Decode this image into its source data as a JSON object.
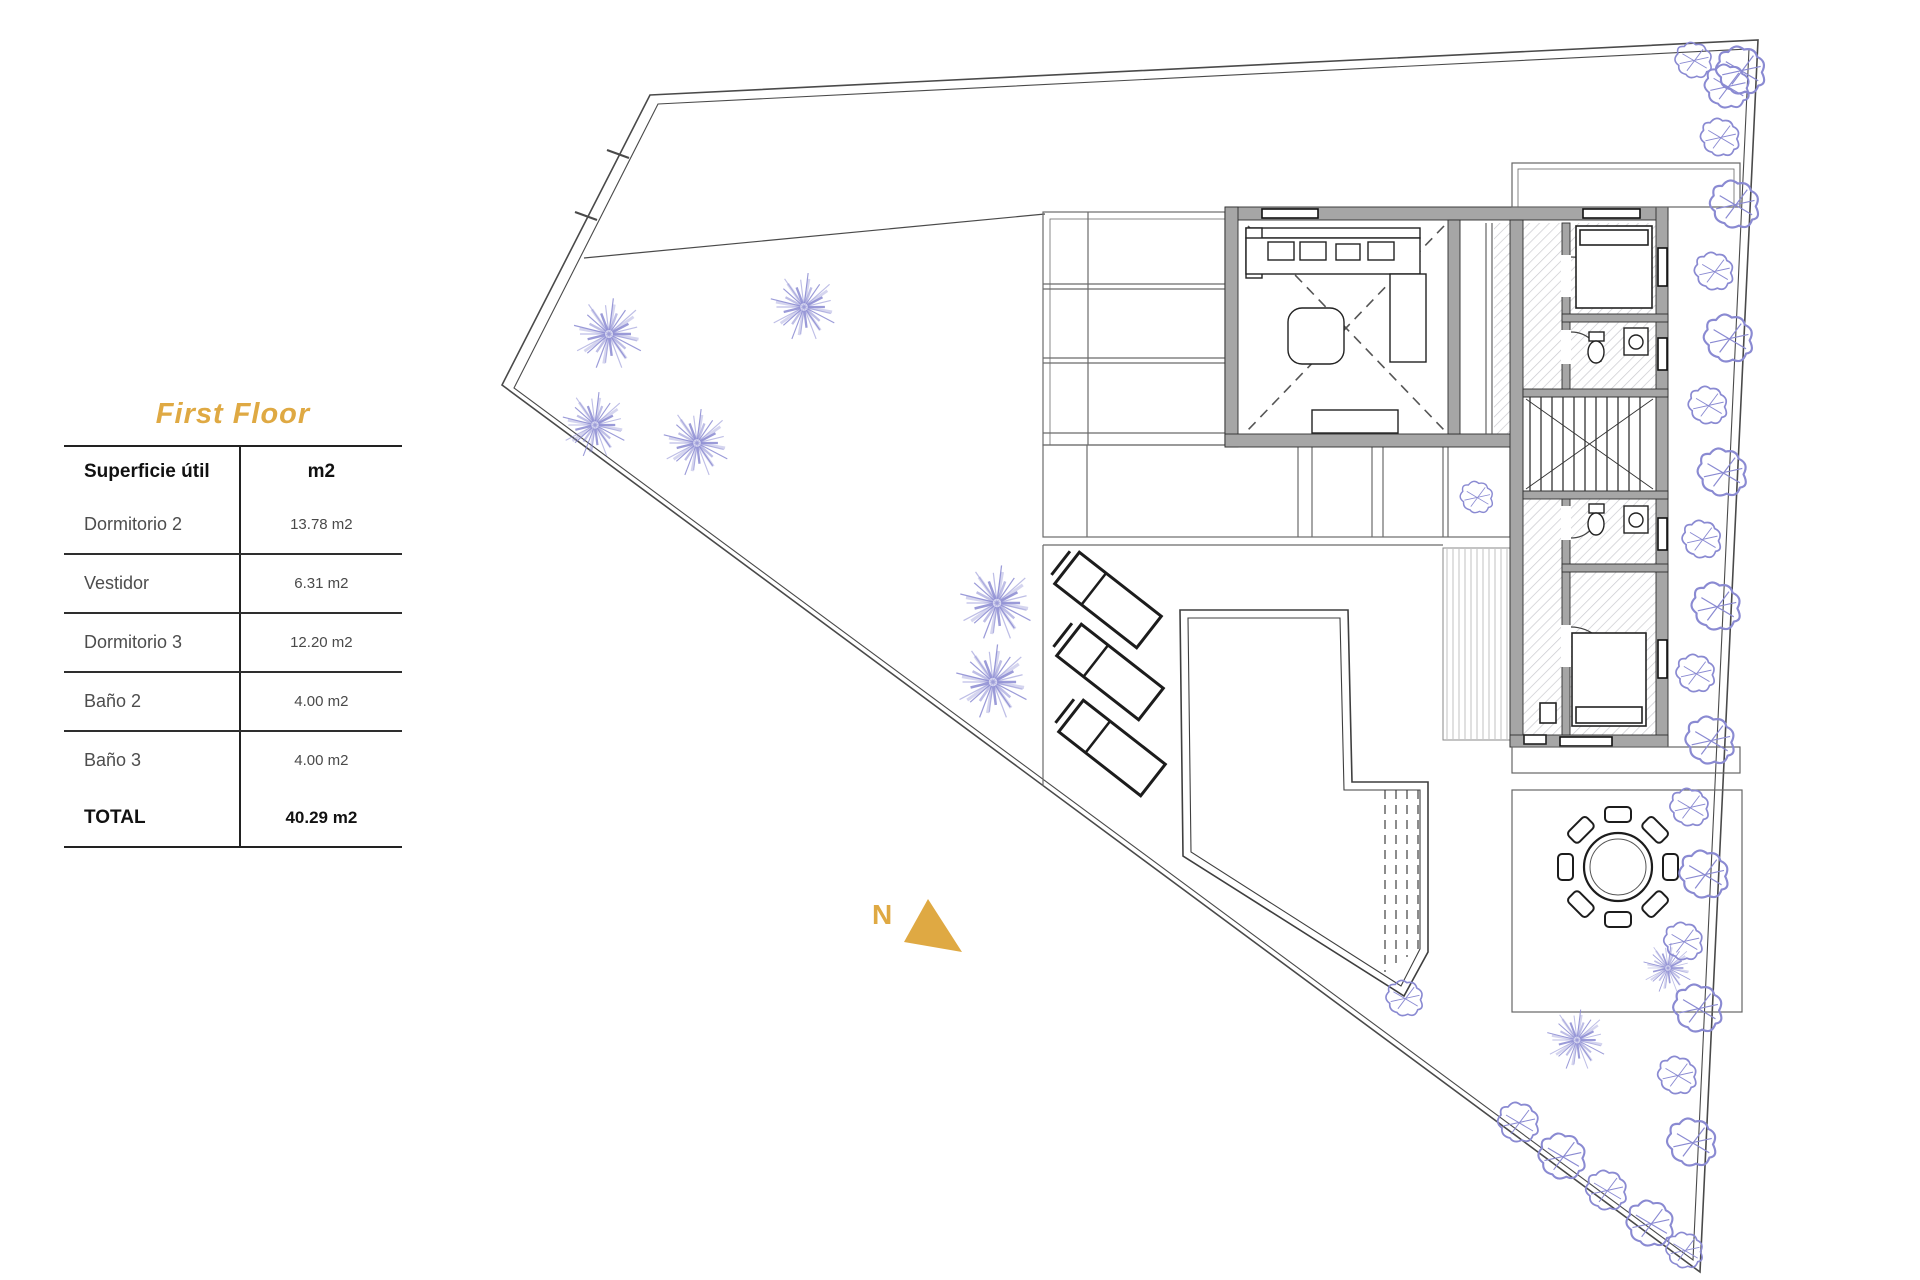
{
  "title": {
    "text": "First Floor"
  },
  "table": {
    "header": {
      "label": "Superficie útil",
      "unit": "m2"
    },
    "rows": [
      {
        "label": "Dormitorio 2",
        "value": "13.78 m2"
      },
      {
        "label": "Vestidor",
        "value": "6.31 m2"
      },
      {
        "label": "Dormitorio 3",
        "value": "12.20 m2"
      },
      {
        "label": "Baño 2",
        "value": "4.00 m2"
      },
      {
        "label": "Baño 3",
        "value": "4.00 m2"
      }
    ],
    "total": {
      "label": "TOTAL",
      "value": "40.29 m2"
    }
  },
  "plan": {
    "north_label": "N"
  },
  "colors": {
    "accent_gold": "#dfa943",
    "vegetation": "#8a8ad2",
    "wall_gray": "#a6a6a6",
    "line_dark": "#444444",
    "hatch_gray": "#c9c9ce"
  }
}
